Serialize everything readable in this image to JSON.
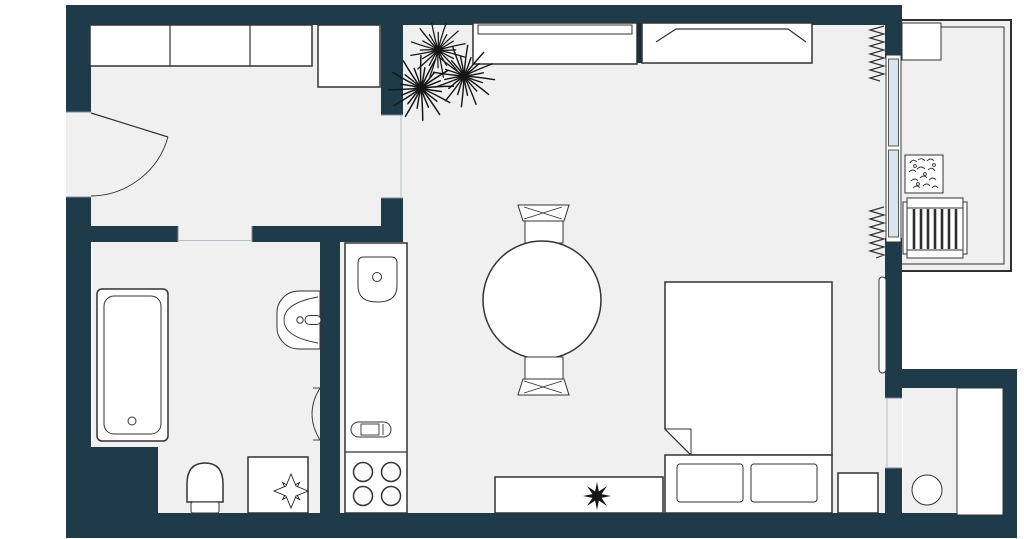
{
  "title": "apartment-floor-plan",
  "palette": {
    "wall": "#1f3b4a",
    "floor": "#f0f0f0",
    "line": "#333333",
    "glass": "#d7e5ec",
    "plant": "#161616",
    "background": "#ffffff"
  },
  "rooms": [
    "entry-hall",
    "bathroom",
    "kitchen-living-room",
    "storage-room",
    "balcony"
  ],
  "furniture": [
    "entry-closet",
    "entry-cabinet",
    "entry-door",
    "bathtub",
    "bathroom-sink",
    "toilet",
    "bathroom-table",
    "flower-decor",
    "kitchen-counter",
    "kitchen-sink",
    "stove-burners",
    "cutting-board",
    "dining-table",
    "dining-chair-top",
    "dining-chair-bottom",
    "sofa",
    "wardrobe",
    "plant-cluster",
    "bed",
    "pillows",
    "nightstand",
    "tv-stand",
    "plant-on-tv-stand",
    "radiator",
    "window",
    "curtain-top",
    "curtain-bottom",
    "balcony-railing",
    "balcony-shelf",
    "balcony-planter",
    "balcony-radiator",
    "laundry-basin",
    "storage-cabinet"
  ]
}
